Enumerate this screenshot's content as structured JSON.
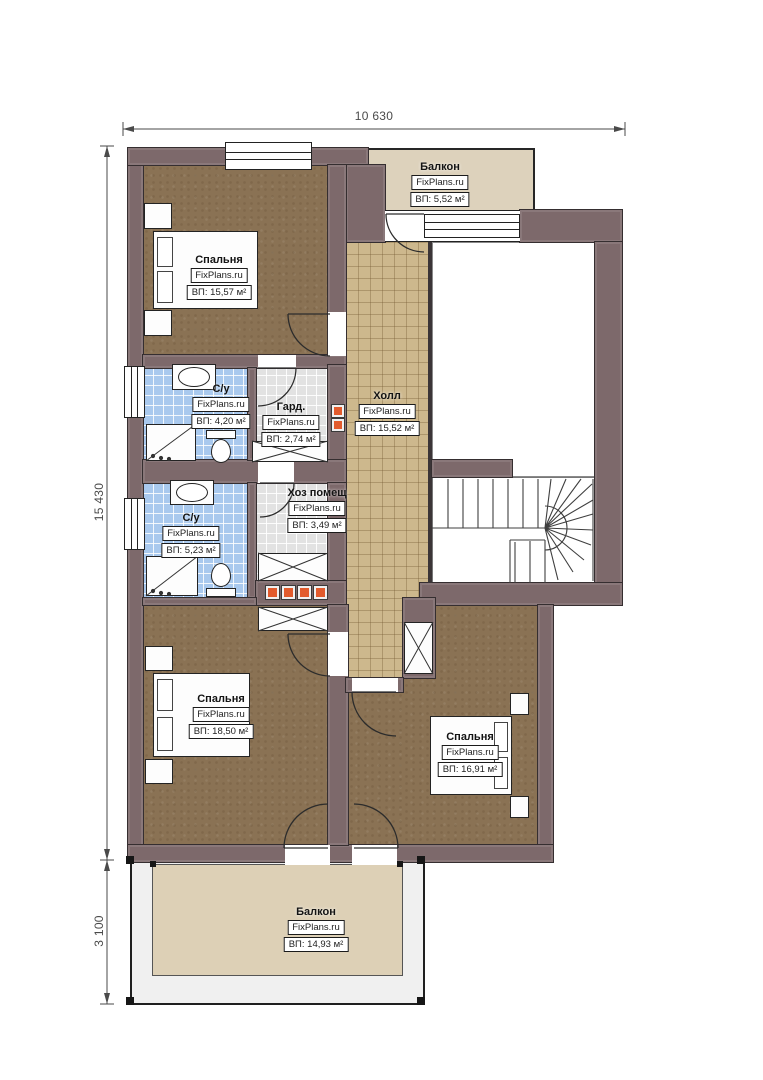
{
  "watermark": "FixPlans.ru",
  "dimensions": {
    "top": "10 630",
    "left_main": "15 430",
    "left_balcony": "3 100"
  },
  "rooms": [
    {
      "id": "balcony-top",
      "name": "Балкон",
      "area": "ВП: 5,52 м²"
    },
    {
      "id": "bedroom-top-left",
      "name": "Спальня",
      "area": "ВП: 15,57 м²"
    },
    {
      "id": "bathroom-1",
      "name": "С/у",
      "area": "ВП: 4,20 м²"
    },
    {
      "id": "wardrobe",
      "name": "Гард.",
      "area": "ВП: 2,74 м²"
    },
    {
      "id": "hall",
      "name": "Холл",
      "area": "ВП: 15,52 м²"
    },
    {
      "id": "utility",
      "name": "Хоз помещ",
      "area": "ВП: 3,49 м²"
    },
    {
      "id": "bathroom-2",
      "name": "С/у",
      "area": "ВП: 5,23 м²"
    },
    {
      "id": "bedroom-bottom-left",
      "name": "Спальня",
      "area": "ВП: 18,50 м²"
    },
    {
      "id": "bedroom-bottom-right",
      "name": "Спальня",
      "area": "ВП: 16,91 м²"
    },
    {
      "id": "balcony-bottom",
      "name": "Балкон",
      "area": "ВП: 14,93 м²"
    }
  ],
  "colors": {
    "wall": "#7d696b",
    "wall_dark": "#3b3537",
    "bedroom_floor": "#8a7254",
    "hall_floor": "#cdb88d",
    "bath_floor": "#a9c9ee",
    "utility_floor": "#e2e2e2",
    "balcony_top_floor": "#ddd2bc",
    "balcony_bottom_floor": "#ddd0b6",
    "accent_orange": "#e25b2d",
    "dimension_text": "#4a4a4a"
  }
}
